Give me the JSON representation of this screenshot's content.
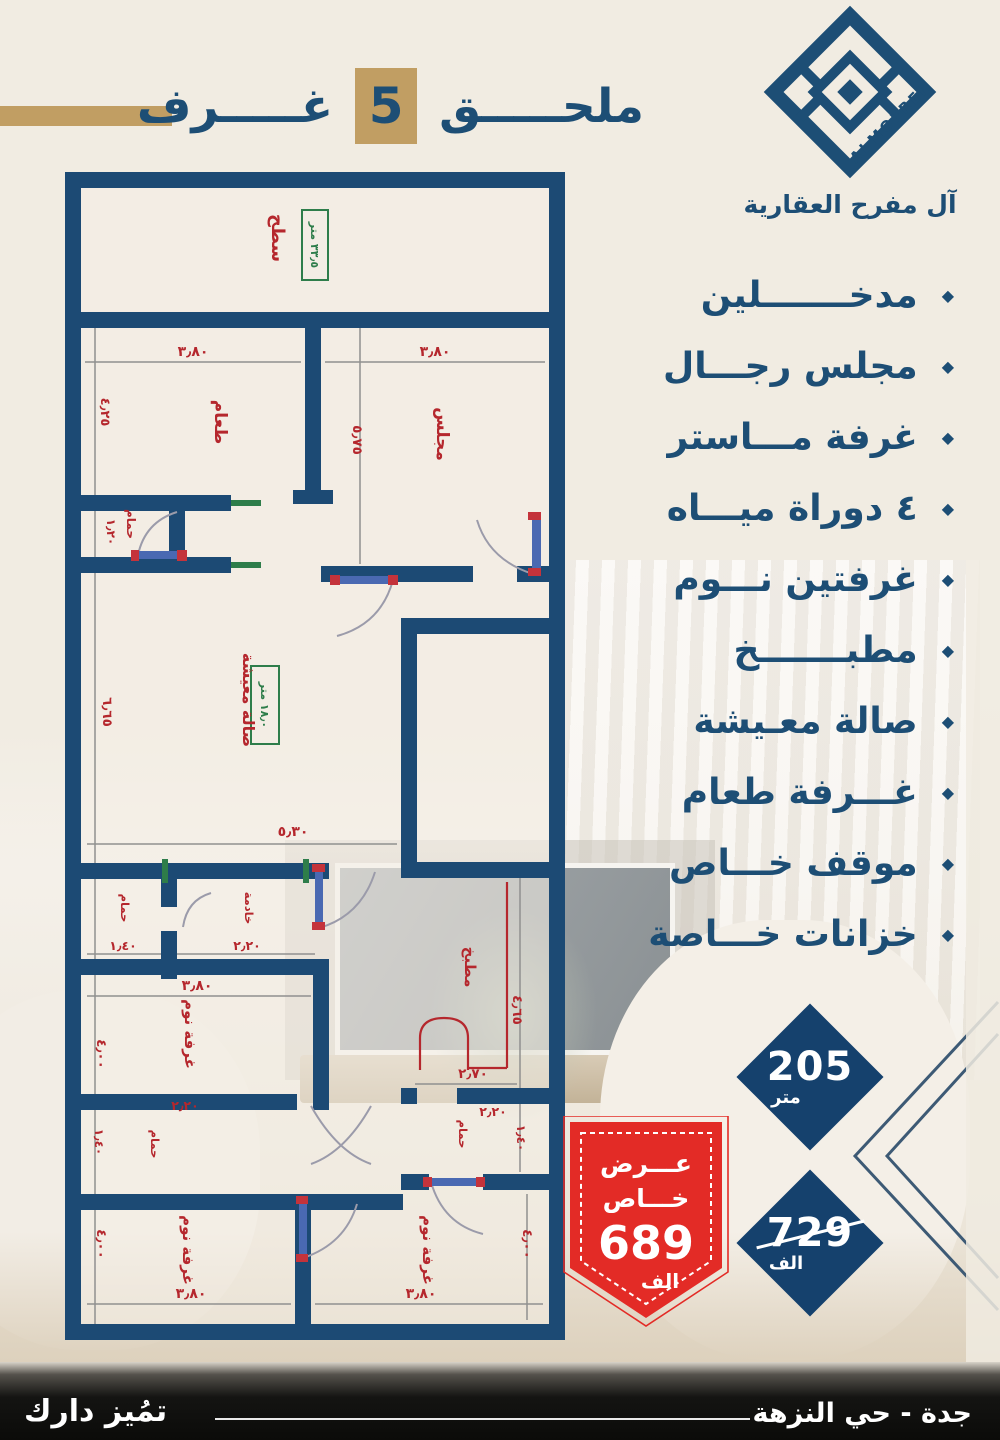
{
  "header": {
    "title_main": "ملحـــــق",
    "title_number": "5",
    "title_rooms": "غـــــرف"
  },
  "logo": {
    "brand_en": "ALMOFREH",
    "brand_ar": "آل مفرح العقارية"
  },
  "features": {
    "items": [
      "مدخـــــــلين",
      "مجلس رجـــال",
      "غرفة مـــاستر",
      "٤ دوراة ميـــاه",
      "غرفتين نـــوم",
      "مطبـــــــخ",
      "صالة معـيشة",
      "غـــرفة طعام",
      "موقف خـــاص",
      "خزانات خـــاصة"
    ]
  },
  "plan": {
    "rooms": {
      "roof": "سطح",
      "dining": "طعام",
      "majlis": "مجلس",
      "bath": "حمام",
      "living": "صالة معيشة",
      "maid": "خادمة",
      "bedroom": "غرفة نوم",
      "kitchen": "مطبخ"
    },
    "areas": {
      "roof": "٣٣٫٥ متر",
      "living": "١٨٫٠ متر"
    },
    "dims": {
      "d380": "٣٫٨٠",
      "d425": "٤٫٢٥",
      "d575": "٥٫٧٥",
      "d120": "١٫٢٠",
      "d665": "٦٫٦٥",
      "d530": "٥٫٣٠",
      "d140": "١٫٤٠",
      "d220": "٢٫٢٠",
      "d400": "٤٫٠٠",
      "d465": "٤٫٦٥",
      "d270": "٢٫٧٠"
    }
  },
  "badges": {
    "area_value": "205",
    "area_unit": "متر",
    "old_price_value": "729",
    "old_price_unit": "الف",
    "offer_word1": "عـــرض",
    "offer_word2": "خـــاص",
    "offer_value": "689",
    "offer_unit": "الف"
  },
  "footer": {
    "brand": "تمُيز دارك",
    "location": "جدة - حي النزهة"
  },
  "colors": {
    "navy": "#1d4e75",
    "wall_navy": "#1c4a74",
    "gold": "#c19e63",
    "dim_red": "#b5272d",
    "green": "#2e7d4a",
    "badge_navy": "#15416d",
    "offer_red": "#e32b26"
  }
}
